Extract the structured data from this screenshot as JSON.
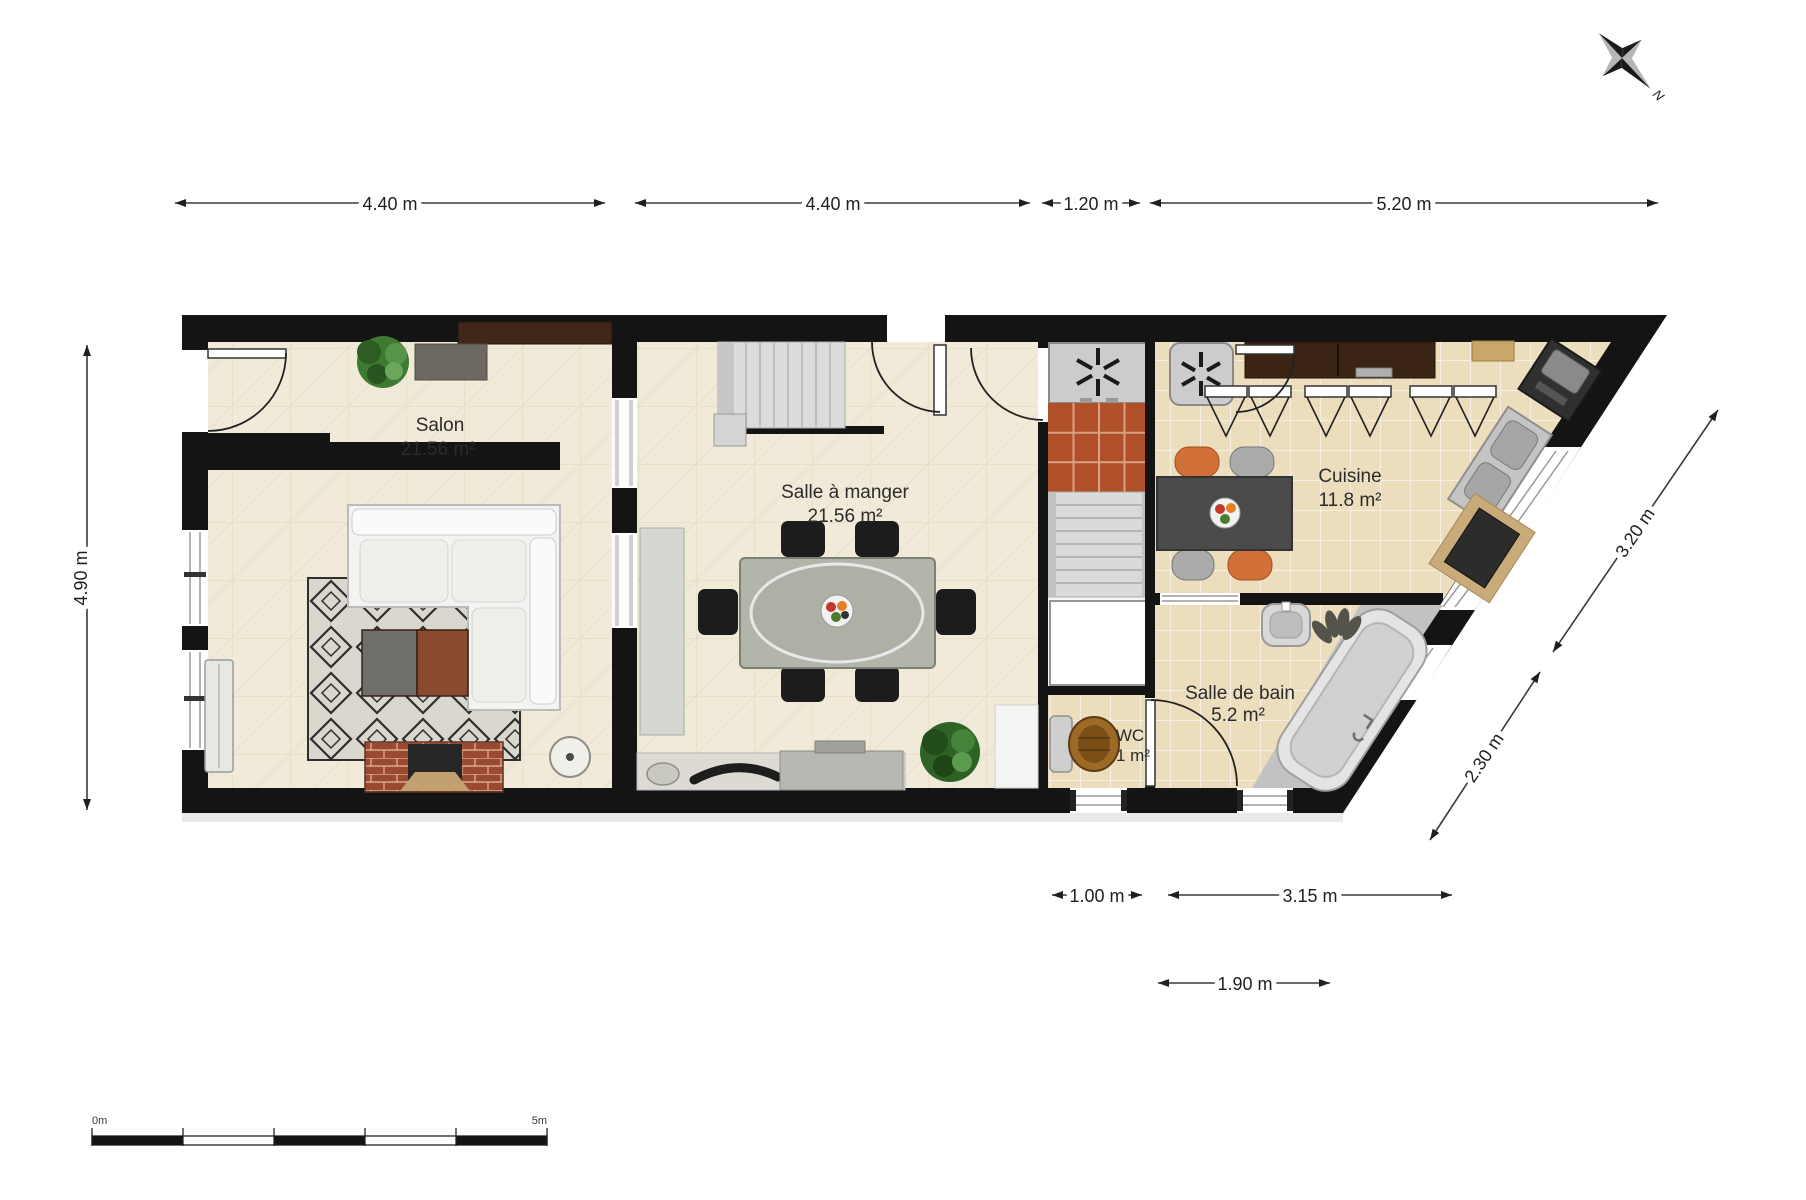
{
  "rooms": [
    {
      "id": "salon",
      "name": "Salon",
      "area": "21.56 m²"
    },
    {
      "id": "salle-a-manger",
      "name": "Salle à manger",
      "area": "21.56 m²"
    },
    {
      "id": "cuisine",
      "name": "Cuisine",
      "area": "11.8 m²"
    },
    {
      "id": "salle-de-bain",
      "name": "Salle de bain",
      "area": "5.2 m²"
    },
    {
      "id": "wc",
      "name": "WC",
      "area": "1 m²"
    }
  ],
  "dimensions": {
    "top": [
      "4.40 m",
      "4.40 m",
      "1.20 m",
      "5.20 m"
    ],
    "left": "4.90 m",
    "right": [
      "3.20 m",
      "2.30 m"
    ],
    "bottom": [
      "1.00 m",
      "3.15 m"
    ],
    "bottom_lower": "1.90 m"
  },
  "scale_bar": {
    "start_label": "0m",
    "end_label": "5m"
  },
  "compass": {
    "north_label": "N"
  },
  "colors": {
    "wall": "#141414",
    "floor_living": "#f1ead9",
    "floor_tile": "#ecddbc",
    "hall_tile_orange": "#b05028",
    "counter_brown": "#3c2415",
    "chair_orange": "#d2703a",
    "chair_gray": "#ababab",
    "dining_chair_black": "#1c1c1c",
    "kitchen_table_gray": "#4a4a4a",
    "rug_base": "#d9d7ce",
    "brick": "#994a31"
  }
}
